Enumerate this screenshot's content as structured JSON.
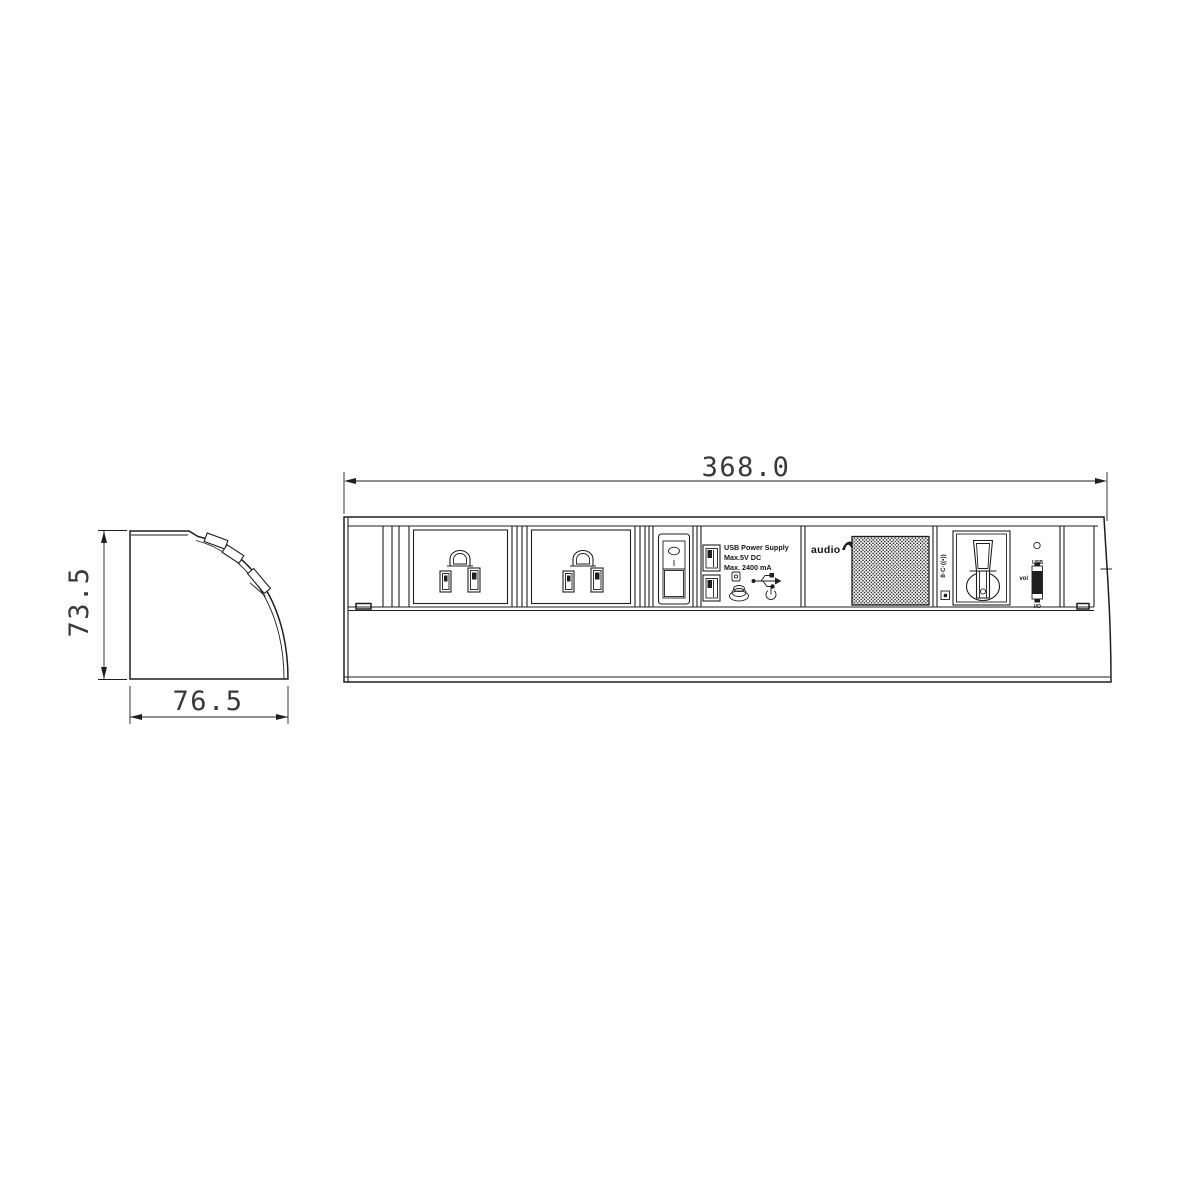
{
  "drawing": {
    "front_width_dim": "368.0",
    "profile_height_dim": "73.5",
    "profile_depth_dim": "76.5"
  },
  "usb_module": {
    "line1": "USB Power Supply",
    "line2": "Max.5V DC",
    "line3": "Max. 2400 mA"
  },
  "audio_module": {
    "brand": "audio"
  },
  "media_module": {
    "side_icons": "8·C·((•))",
    "usb_label": "USB",
    "vol_label": "vol",
    "io_label": "I/O"
  }
}
